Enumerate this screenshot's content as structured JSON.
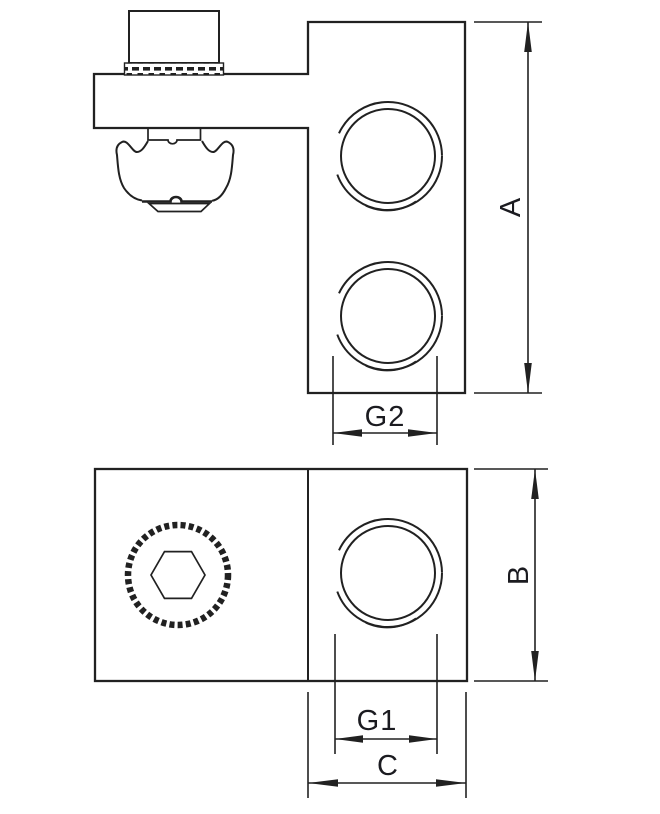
{
  "colors": {
    "line": "#212121",
    "text": "#1b1b20",
    "background": "#ffffff"
  },
  "drawing": {
    "dimensions": {
      "a": {
        "label": "A"
      },
      "b": {
        "label": "B"
      },
      "c": {
        "label": "C"
      },
      "g1": {
        "label": "G1"
      },
      "g2": {
        "label": "G2"
      }
    }
  }
}
